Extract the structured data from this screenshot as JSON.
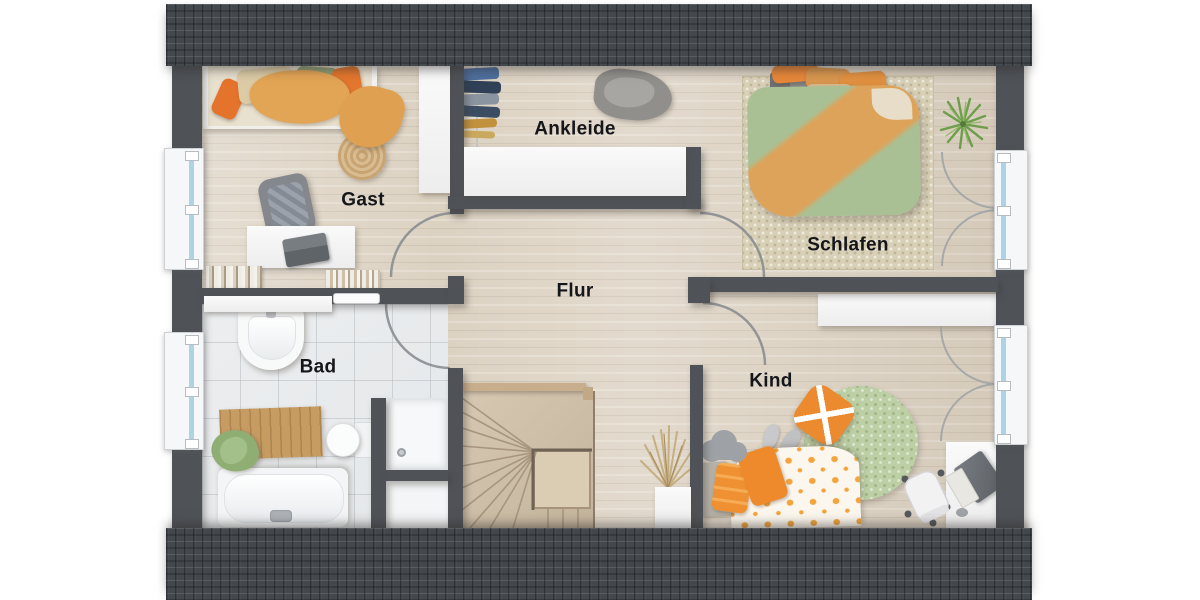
{
  "type": "floor-plan",
  "rooms": [
    {
      "id": "gast",
      "label": "Gast"
    },
    {
      "id": "ankleide",
      "label": "Ankleide"
    },
    {
      "id": "schlafen",
      "label": "Schlafen"
    },
    {
      "id": "flur",
      "label": "Flur"
    },
    {
      "id": "bad",
      "label": "Bad"
    },
    {
      "id": "kind",
      "label": "Kind"
    }
  ],
  "palette": {
    "roof": "#43484d",
    "wall": "#4f5358",
    "wood_floor": "#dcd2c2",
    "tile_floor": "#eaeced",
    "window_glass": "#aed2e6",
    "duvet_green": "#a9c094",
    "blanket_orange": "#dda35a",
    "accent_orange": "#ec8a2f",
    "rug_green": "#bccfa5",
    "stairs_wood": "#cfc0ab"
  }
}
